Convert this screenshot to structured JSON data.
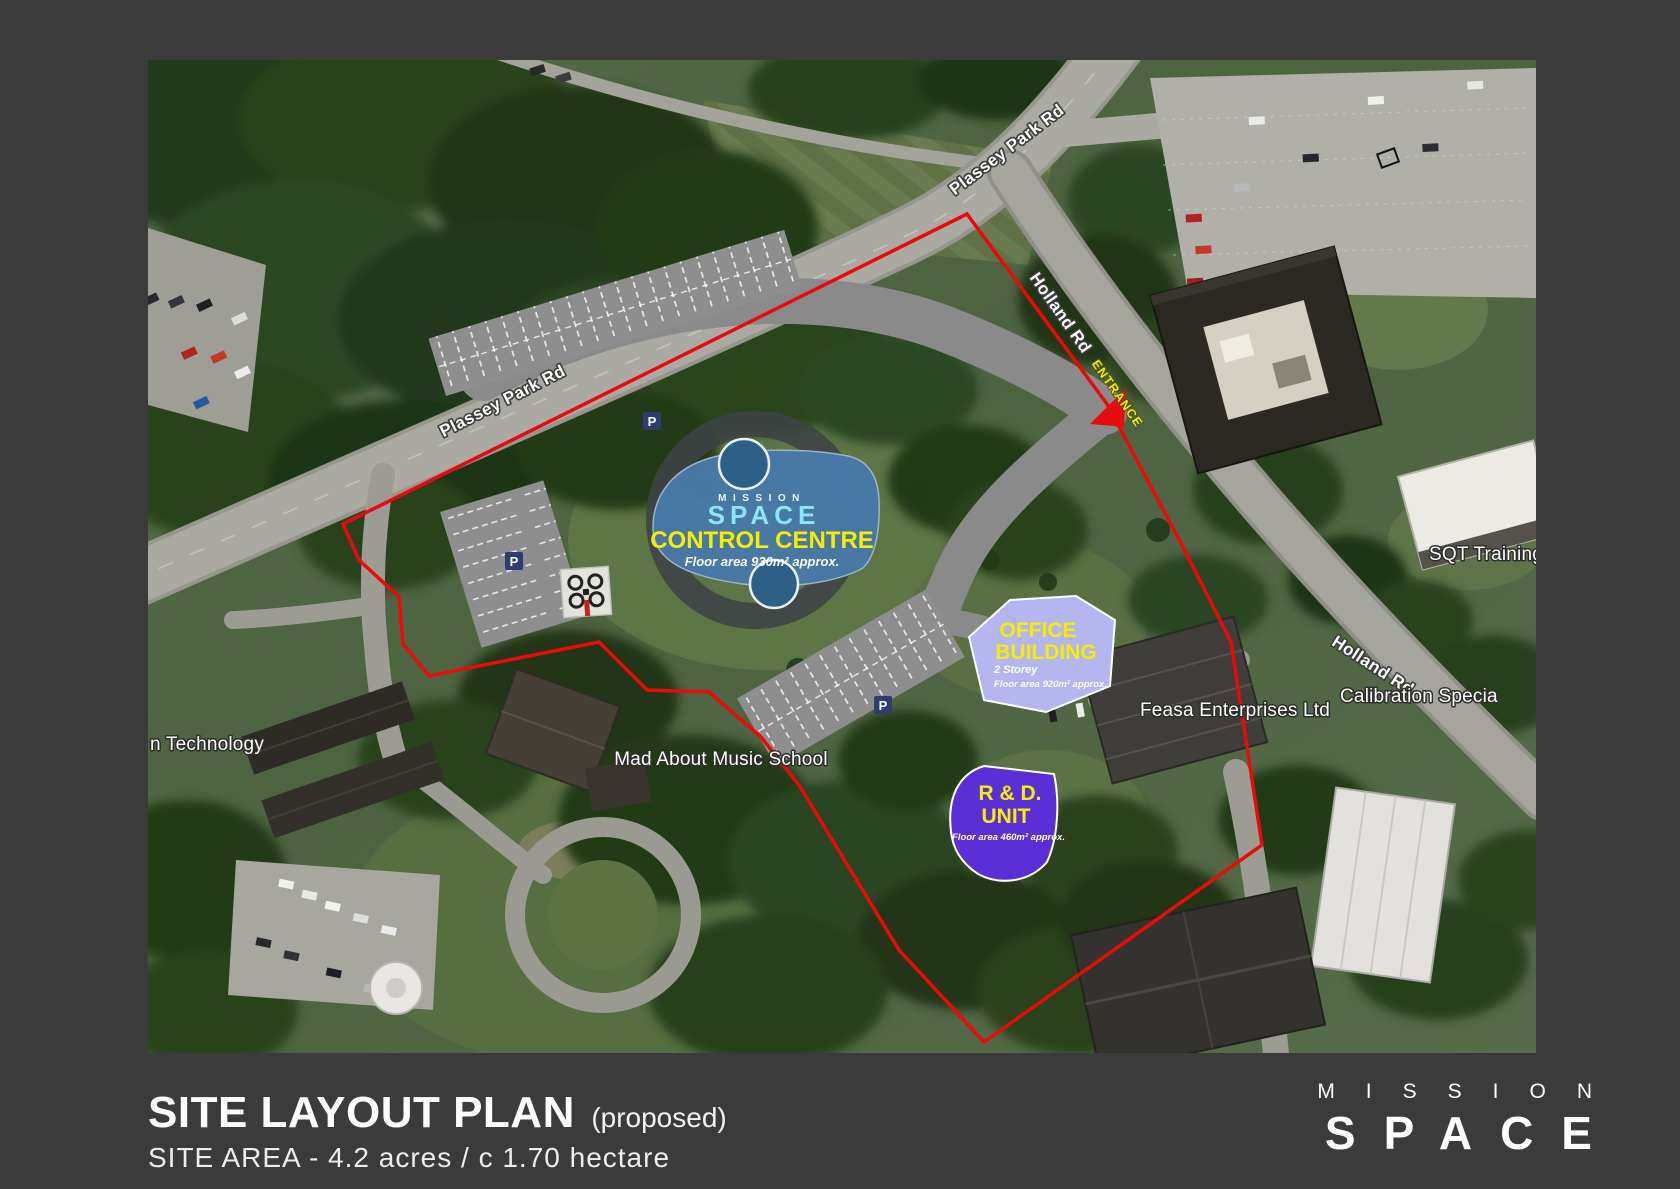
{
  "map": {
    "road_labels": {
      "plassey_top": "Plassey Park Rd",
      "plassey_left": "Plassey Park Rd",
      "holland_upper": "Holland Rd",
      "holland_lower": "Holland Rd"
    },
    "entrance_label": "ENTRANCE",
    "place_labels": {
      "technology": "n Technology",
      "music_school": "Mad About Music School",
      "feasa": "Feasa Enterprises Ltd",
      "sqt": "SQT Training",
      "calibration": "Calibration Specia"
    },
    "parking_badge": "P",
    "boundary_color": "#ea0a0a",
    "buildings": {
      "control_centre": {
        "brand_top": "MISSION",
        "brand_main": "SPACE",
        "name": "CONTROL CENTRE",
        "detail": "Floor area 930m² approx.",
        "fill": "#4879a8"
      },
      "office": {
        "line1": "OFFICE",
        "line2": "BUILDING",
        "storey": "2 Storey",
        "detail": "Floor area 920m² approx.",
        "fill": "#b5b5f0"
      },
      "rd_unit": {
        "line1": "R & D.",
        "line2": "UNIT",
        "detail": "Floor area 460m² approx.",
        "fill": "#5b2fd6"
      }
    }
  },
  "footer": {
    "title": "SITE LAYOUT PLAN",
    "title_suffix": "(proposed)",
    "subtitle": "SITE AREA - 4.2 acres / c 1.70 hectare",
    "logo": {
      "top": "MISSION",
      "main": "SPACE"
    }
  }
}
